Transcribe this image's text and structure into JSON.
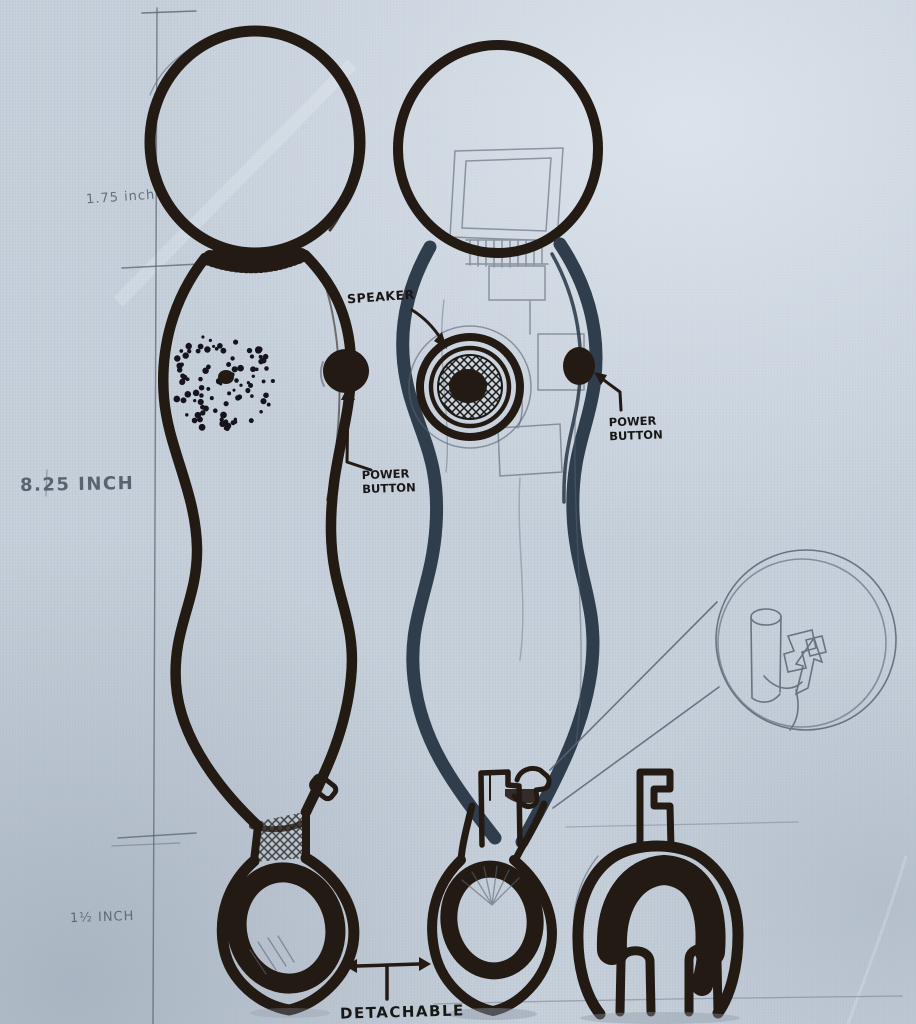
{
  "annotations": {
    "head_diameter": "1.75 inch",
    "body_length": "8.25 INCH",
    "attachment_height": "1½ INCH",
    "speaker": "SPEAKER",
    "power_button_front": "POWER BUTTON",
    "power_button_side": "POWER BUTTON",
    "detachable": "DETACHABLE"
  },
  "colors": {
    "paper": "#c5cfda",
    "marker_dark": "#231a14",
    "ink_slate": "#2f3d4c",
    "pencil": "#5a6472",
    "text_marker": "#191715",
    "pencil_text": "#4e5866"
  }
}
